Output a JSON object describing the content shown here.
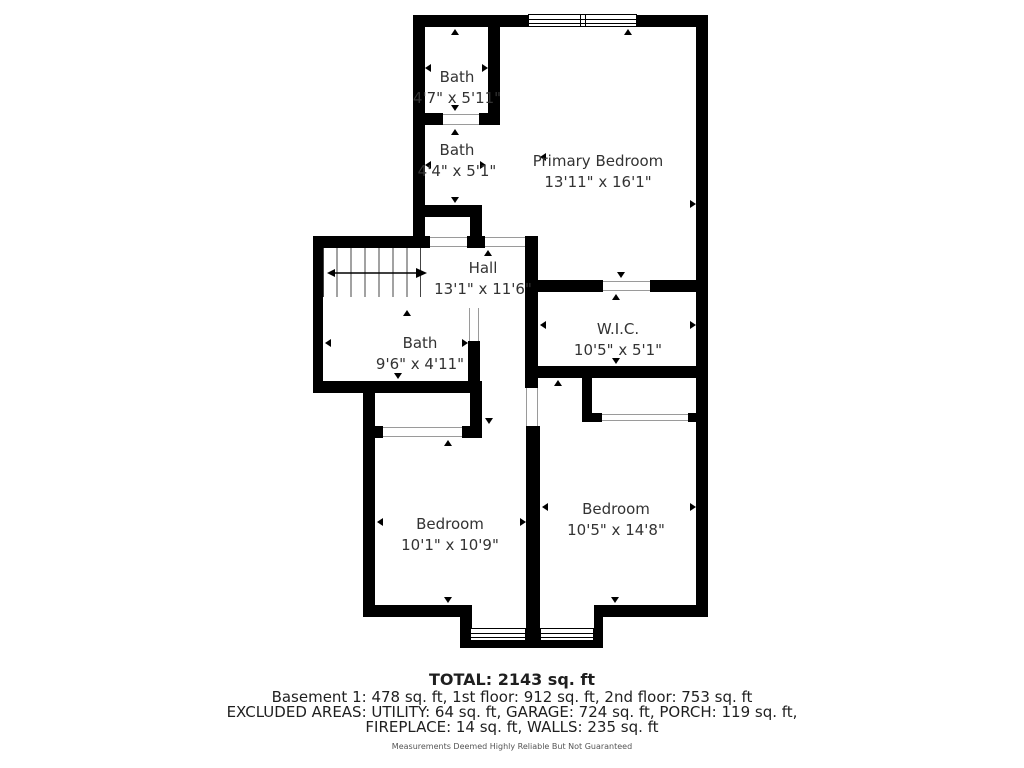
{
  "plan": {
    "rooms": [
      {
        "name": "Bath",
        "dims": "4'7\" x 5'11\""
      },
      {
        "name": "Bath",
        "dims": "4'4\" x 5'1\""
      },
      {
        "name": "Primary Bedroom",
        "dims": "13'11\" x 16'1\""
      },
      {
        "name": "Hall",
        "dims": "13'1\" x 11'6\""
      },
      {
        "name": "Bath",
        "dims": "9'6\" x 4'11\""
      },
      {
        "name": "W.I.C.",
        "dims": "10'5\" x 5'1\""
      },
      {
        "name": "Bedroom",
        "dims": "10'1\" x 10'9\""
      },
      {
        "name": "Bedroom",
        "dims": "10'5\" x 14'8\""
      }
    ]
  },
  "summary": {
    "total": "TOTAL: 2143 sq. ft",
    "floors": "Basement 1: 478 sq. ft, 1st floor: 912 sq. ft, 2nd floor: 753 sq. ft",
    "excluded_1": "EXCLUDED AREAS: UTILITY: 64 sq. ft, GARAGE: 724 sq. ft, PORCH: 119 sq. ft,",
    "excluded_2": "FIREPLACE: 14 sq. ft, WALLS: 235 sq. ft",
    "disclaimer": "Measurements Deemed Highly Reliable But Not Guaranteed"
  },
  "colors": {
    "wall": "#000000",
    "text": "#333333"
  }
}
